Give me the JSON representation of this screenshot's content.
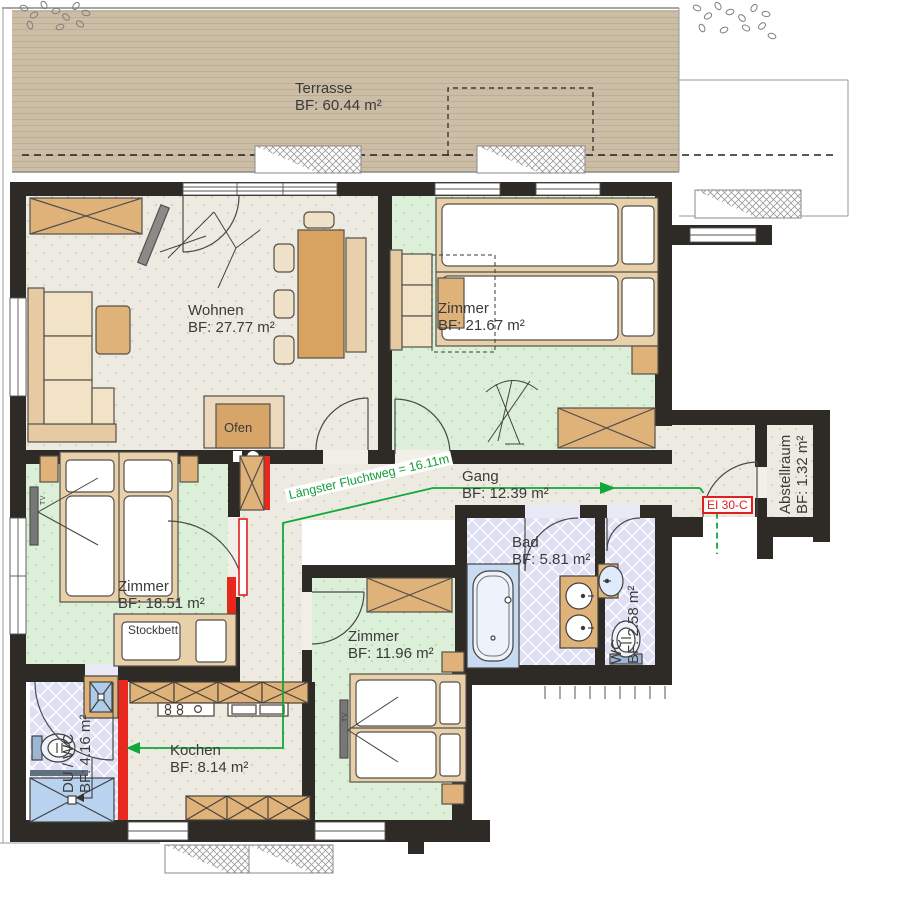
{
  "plan_title": "Wohnungsgrundriss",
  "rooms": {
    "terrasse": {
      "name": "Terrasse",
      "area": "BF: 60.44 m²"
    },
    "wohnen": {
      "name": "Wohnen",
      "area": "BF: 27.77 m²"
    },
    "zimmer_ne": {
      "name": "Zimmer",
      "area": "BF: 21.67 m²"
    },
    "gang": {
      "name": "Gang",
      "area": "BF: 12.39 m²"
    },
    "abstellraum": {
      "name": "Abstellraum",
      "area": "BF: 1.32 m²"
    },
    "zimmer_w": {
      "name": "Zimmer",
      "area": "BF: 18.51 m²"
    },
    "bad": {
      "name": "Bad",
      "area": "BF: 5.81 m²"
    },
    "wc": {
      "name": "WC",
      "area": "BF: 2.58 m²"
    },
    "zimmer_s": {
      "name": "Zimmer",
      "area": "BF: 11.96 m²"
    },
    "kochen": {
      "name": "Kochen",
      "area": "BF: 8.14 m²"
    },
    "du_wc": {
      "name": "DU / WC",
      "area": "BF: 4.16 m²"
    }
  },
  "annotations": {
    "escape_route": "Längster Fluchtweg = 16.11m",
    "fire_door": "EI 30-C",
    "oven": "Ofen",
    "bunk_bed": "Stockbett",
    "tv": "TV"
  },
  "colors": {
    "wall": "#2e2a26",
    "terrace": "#cbbda6",
    "floor_beige": "#edeae1",
    "floor_green": "#dcefd8",
    "floor_tile": "#dfdff4",
    "furniture_tan": "#dfb27a",
    "furniture_light": "#ecd9bd",
    "water_blue": "#c3d7ef",
    "escape_green": "#12a73b",
    "fire_red": "#e02020"
  }
}
